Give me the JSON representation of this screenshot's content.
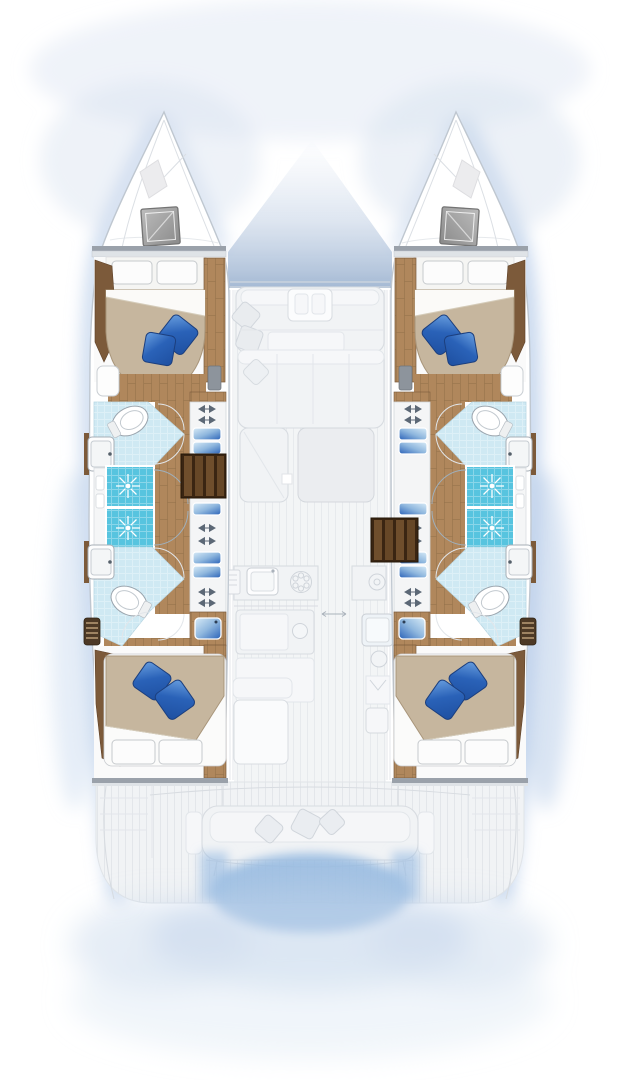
{
  "title": "Catamaran interior layout plan — 4 cabins / 4 heads, top-down view",
  "notes": "Interior hull accommodations rendered in colour; bridge-deck, foredeck and cockpit shown ghosted. No text labels are visible in the plan.",
  "colors": {
    "page-bg": "#ffffff",
    "glow": "#b7cce9",
    "glow-deep": "#94b8e0",
    "water": "#9cbfe3",
    "hull-stroke": "#bfc7d0",
    "hull-fill": "#ffffff",
    "ghost-fill": "#f1f3f5",
    "ghost-line": "#d8dce1",
    "ghost-dark": "#e2e6ea",
    "deck-line": "#e3e6ea",
    "wood": "#b0875c",
    "wood-line": "#93704a",
    "wood-dark": "#7c5a3a",
    "stair-dark": "#3a2512",
    "stair-light": "#6f4e2c",
    "bulkhead": "#9aa1aa",
    "bath": "#cfe9f3",
    "shower": "#57c4df",
    "duvet": "#c6b69e",
    "duvet-line": "#a8957a",
    "pillow": "#fcfcfc",
    "pillow-line": "#c6cacd",
    "cushion1": "#2a62b8",
    "cushion2": "#1e4fa0",
    "cushion-hi": "#6aa0e0",
    "hatch1": "#bcbcbc",
    "hatch2": "#8a8a8a",
    "fixture-line": "#9aa4ad",
    "sinkblue1": "#8fb7de",
    "sinkblue2": "#d8ebf7",
    "hinge": "#5c6876"
  },
  "icons": [
    "deck-hatch-icon",
    "toilet-icon",
    "washbasin-icon",
    "shower-head-icon",
    "door-swing-arc-icon",
    "hinge-icon",
    "drawer-icon",
    "vanity-sink-icon",
    "louver-vent-icon",
    "stove-burner-icon",
    "galley-sink-icon",
    "sliding-door-arrow-icon",
    "pillow-icon",
    "cushion-icon",
    "stairs-icon"
  ],
  "vessel": {
    "type": "sailing catamaran floor plan",
    "hulls": [
      {
        "side": "port",
        "spaces": [
          {
            "name": "bow locker",
            "features": [
              "deck hatch"
            ]
          },
          {
            "name": "forward cabin",
            "features": [
              "double berth",
              "2 white pillows",
              "2 blue cushions",
              "wardrobe",
              "vanity"
            ]
          },
          {
            "name": "forward head",
            "features": [
              "toilet",
              "washbasin",
              "shower stall"
            ]
          },
          {
            "name": "aft head",
            "features": [
              "toilet",
              "washbasin",
              "shower stall"
            ]
          },
          {
            "name": "companionway stairs",
            "features": [
              "teak steps"
            ]
          },
          {
            "name": "aft cabin",
            "features": [
              "double berth",
              "2 white pillows",
              "2 blue cushions",
              "vanity washbasin",
              "louver vent"
            ]
          }
        ]
      },
      {
        "side": "starboard",
        "spaces": [
          {
            "name": "bow locker",
            "features": [
              "deck hatch"
            ]
          },
          {
            "name": "forward cabin",
            "features": [
              "double berth",
              "2 white pillows",
              "2 blue cushions",
              "wardrobe",
              "vanity"
            ]
          },
          {
            "name": "forward head",
            "features": [
              "toilet",
              "washbasin",
              "shower stall"
            ]
          },
          {
            "name": "aft head",
            "features": [
              "toilet",
              "washbasin",
              "shower stall"
            ]
          },
          {
            "name": "companionway stairs",
            "features": [
              "teak steps"
            ]
          },
          {
            "name": "aft cabin",
            "features": [
              "double berth",
              "2 white pillows",
              "2 blue cushions",
              "vanity washbasin",
              "louver vent"
            ]
          }
        ]
      }
    ],
    "bridge_deck_ghosted": [
      {
        "name": "foredeck / trampoline gap"
      },
      {
        "name": "forward cockpit",
        "features": [
          "bench seating",
          "2 cushions",
          "center console"
        ]
      },
      {
        "name": "saloon",
        "features": [
          "C-shaped sofa",
          "chaise",
          "coffee table",
          "scatter cushions"
        ]
      },
      {
        "name": "galley",
        "features": [
          "sink",
          "stove with 6 burners",
          "refrigerator island",
          "second sink",
          "second stove"
        ]
      },
      {
        "name": "aft cockpit",
        "features": [
          "table with bench",
          "transom bench seat",
          "3 cushions",
          "teak decking"
        ]
      },
      {
        "name": "swim platform / transoms",
        "features": [
          "steps",
          "water shadow between hulls"
        ]
      }
    ]
  }
}
